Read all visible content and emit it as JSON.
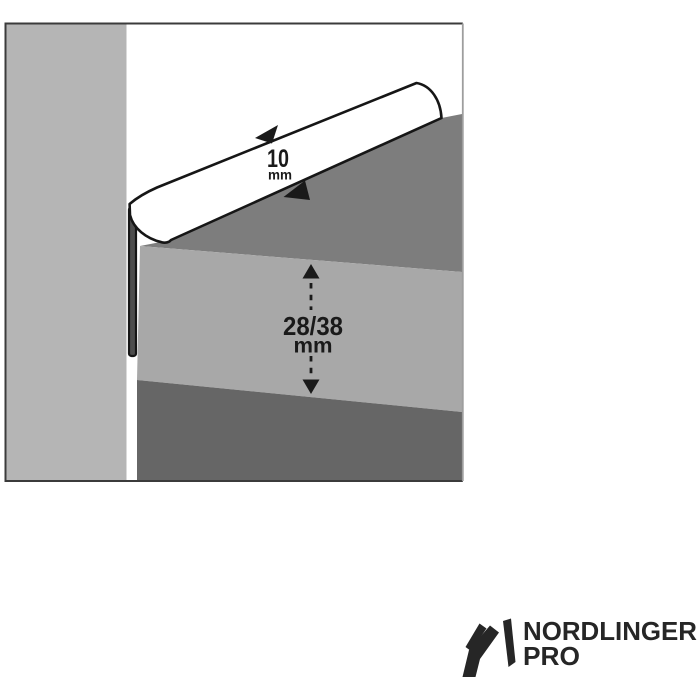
{
  "image": {
    "width": 700,
    "height": 700,
    "background": "#ffffff"
  },
  "diagram": {
    "type": "worktop-edge-profile-cross-section",
    "frame_border_color": "#3b3b3b",
    "frame_border_right_color": "#9e9e9e",
    "colors": {
      "wall": "#b5b5b5",
      "worktop_top": "#7d7d7d",
      "worktop_front": "#a8a8a8",
      "worktop_under": "#666666",
      "profile_fill": "#ffffff",
      "profile_outline": "#161616",
      "flange_fill": "#4d4d4d",
      "ink": "#1a1a1a"
    },
    "dimensions": {
      "profile_face": {
        "value": "10",
        "unit": "mm"
      },
      "worktop_thickness": {
        "value": "28/38",
        "unit": "mm"
      }
    }
  },
  "logo": {
    "brand": "NORDLINGER",
    "sub_brand": "PRO",
    "color": "#262626",
    "mark": "stylized-n"
  }
}
